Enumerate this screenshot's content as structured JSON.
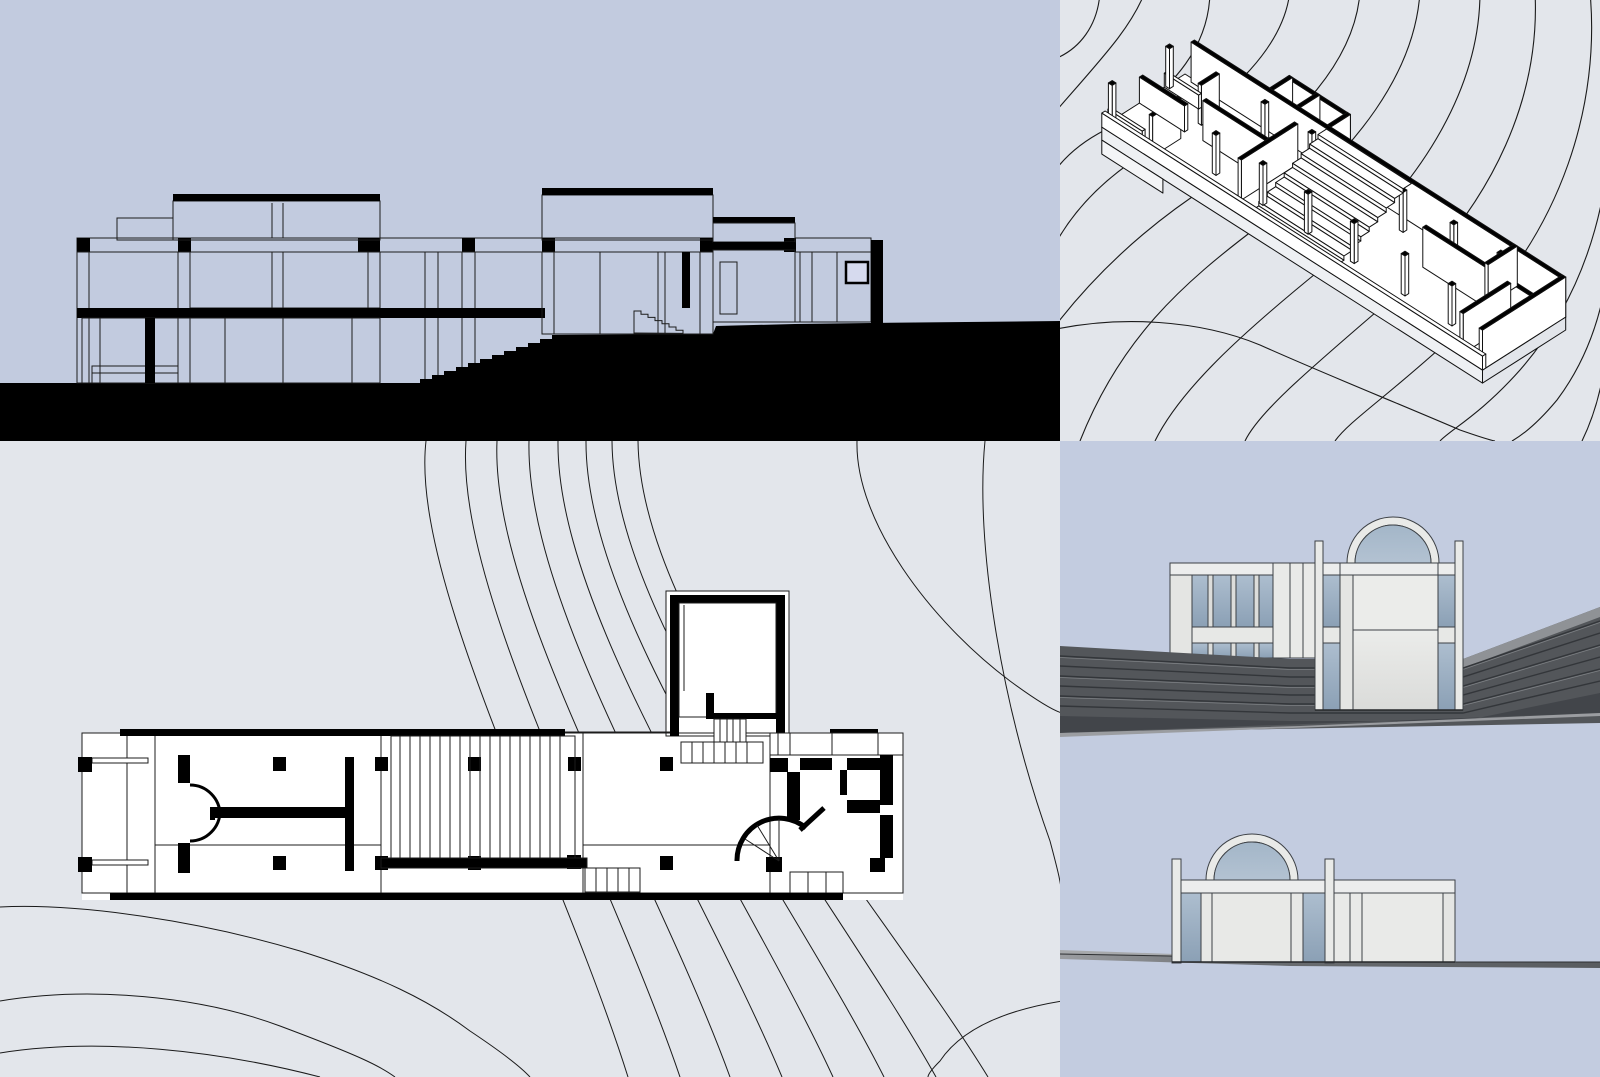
{
  "document": {
    "title": "Modernist hillside house — presentation drawing set",
    "description": "Four-panel architectural presentation: black-and-white site section, cut-away axonometric over contours, ground-floor plan on contoured terrain, and two shaded elevations with arched rooflights."
  },
  "palette": {
    "section_background": "#c2cbdf",
    "plan_background": "#e3e6eb",
    "elevation_background": "#c3cce0",
    "ink": "#000000",
    "wall_white": "#ffffff",
    "render_wall": "#e9eae8",
    "glass_blue": "#9db0c3",
    "arch_glass": "#a8bacc",
    "annex_window": "#d6daee",
    "terrace_dark": "#53565a"
  },
  "panels": [
    {
      "id": "site-section",
      "name": "Site section",
      "position": "top-left",
      "drawing_type": "black-and-white building section with solid poché ground",
      "features": [
        "two flat-roofed pavilions",
        "long connecting roof beam on columns",
        "exterior stair cut into the slope",
        "annex with small tinted window"
      ]
    },
    {
      "id": "axonometric",
      "name": "Cut-away axonometric",
      "position": "top-right",
      "drawing_type": "isometric line drawing of the house over site contour lines",
      "features": [
        "long single-storey bar",
        "central stepped deck",
        "freestanding columns",
        "curved kitchen wall",
        "north stair annex"
      ]
    },
    {
      "id": "floor-plan",
      "name": "Floor plan",
      "position": "bottom-left",
      "drawing_type": "ink floor plan on contoured terrain",
      "features": [
        "west porch with rails",
        "double swing doors",
        "slatted deck",
        "stair tower",
        "quarter-turn fan stair",
        "service rooms"
      ]
    },
    {
      "id": "entry-elevation",
      "name": "Entry elevation (rendered)",
      "position": "right-middle",
      "drawing_type": "shaded elevation",
      "features": [
        "barrel-arched rooflight",
        "banded blue glazing",
        "freestanding pilasters",
        "terraced dark ground"
      ]
    },
    {
      "id": "side-elevation",
      "name": "Side elevation (rendered)",
      "position": "right-bottom",
      "drawing_type": "shaded elevation",
      "features": [
        "arched rooflight",
        "flanking pilasters",
        "thin sloping ground line"
      ]
    }
  ]
}
